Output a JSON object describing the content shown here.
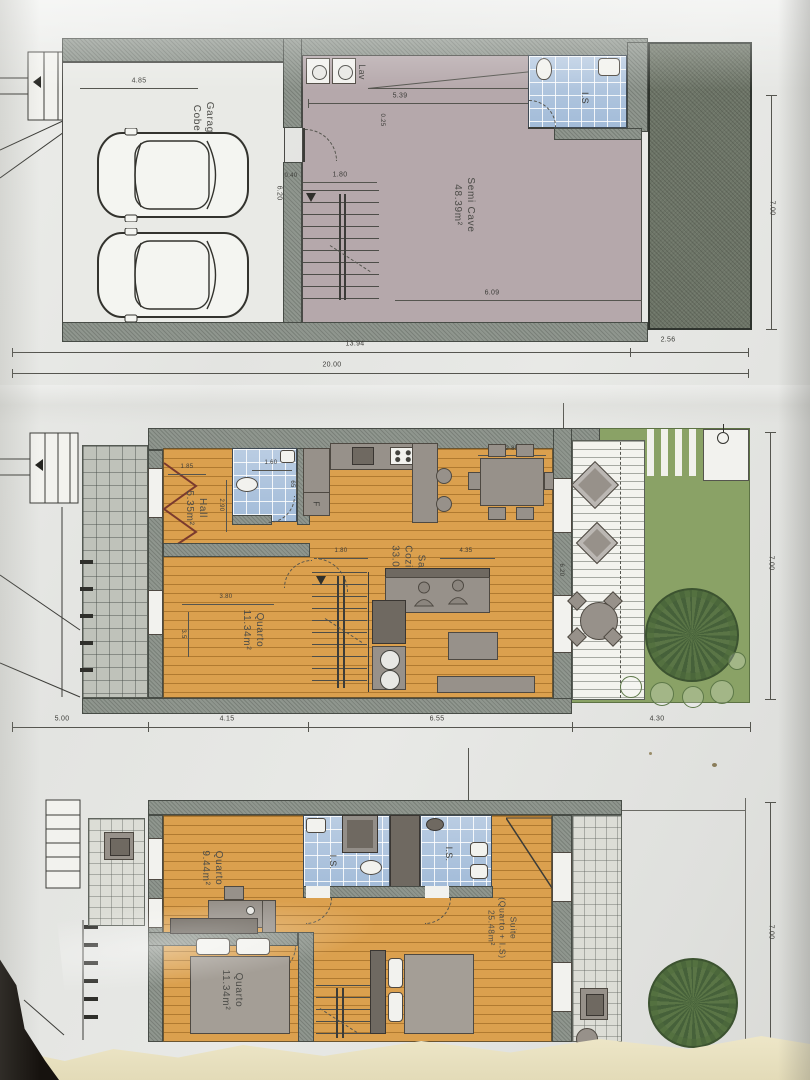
{
  "photo": {
    "description": "Scanned architectural floor plans, three levels"
  },
  "p1": {
    "garage_l1": "Garagem",
    "garage_l2": "Coberta",
    "lav": "Lav",
    "is": "I.S",
    "room_l1": "Semi Cave",
    "room_l2": "48.39m²",
    "d485": "4.85",
    "d620": "6.20",
    "d539": "5.39",
    "d180": "1.80",
    "d040": "0.40",
    "d025": "0.25",
    "d609": "6.09",
    "d1394": "13.94",
    "d256": "2.56",
    "d2000": "20.00",
    "d700": "7.00"
  },
  "p2": {
    "hall_l1": "Hall",
    "hall_l2": "5.35m²",
    "sala_l1": "Sala",
    "sala_l2": "Cozinha",
    "sala_l3": "33.05m²",
    "quarto_l1": "Quarto",
    "quarto_l2": "11.34m²",
    "fridge": "F",
    "d185": "1.85",
    "d290": "2.90",
    "d160": "1.60",
    "d065": "65",
    "d285": "2.85",
    "d435": "4.35",
    "d180": "1.80",
    "d380": "3.80",
    "d35": "3.5",
    "d620": "6.20",
    "d500": "5.00",
    "d415": "4.15",
    "d655": "6.55",
    "d430": "4.30",
    "d700": "7.00"
  },
  "p3": {
    "q1_l1": "Quarto",
    "q1_l2": "9.44m²",
    "q2_l1": "Quarto",
    "q2_l2": "11.34m²",
    "suite_l1": "Suite",
    "suite_l2": "(Quarto + I.S)",
    "suite_l3": "25.48m²",
    "is1": "I.S.",
    "is2": "I.S.",
    "d700": "7.00"
  }
}
